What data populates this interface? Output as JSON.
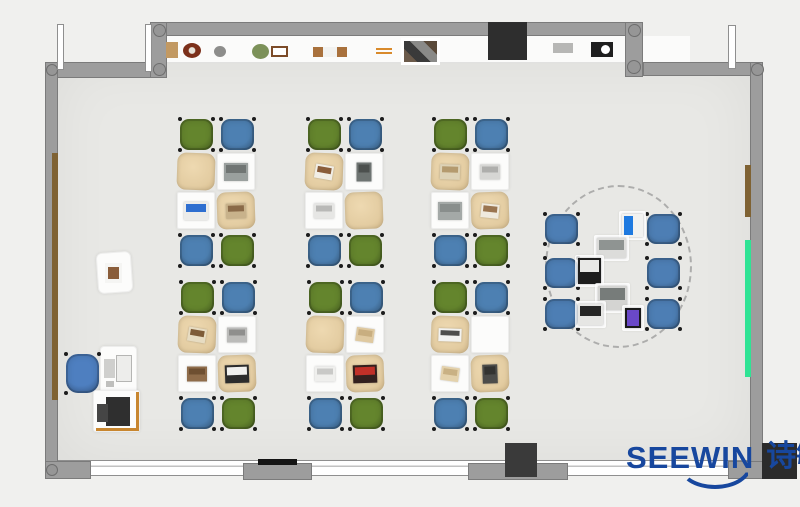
{
  "logo": {
    "text_latin": "SEEWIN",
    "text_cjk": "诗敏",
    "color": "#17479e",
    "x": 626,
    "y": 442
  },
  "palette": {
    "page_bg": "#f0f0ee",
    "floor": "#e8e8e5",
    "wall": "#9d9d9d",
    "alcove": "#fbfbfa",
    "chair_green": "#64852d",
    "chair_blue": "#4d80b2",
    "collab_chair_blue": "#4d7eb4",
    "office_chair_blue": "#4e7fc0",
    "desk_tan": "#e3cca1",
    "desk_white": "#fcfcfb",
    "door_brown": "#7f6233",
    "board_green": "#2fe394",
    "accent_orange": "#c8862f",
    "dark_block": "#2e2e2e"
  },
  "room": {
    "floor": {
      "x": 57,
      "y": 62,
      "w": 693,
      "h": 399
    },
    "alcove": {
      "x": 167,
      "y": 36,
      "w": 458,
      "h": 26
    },
    "alcove_right": {
      "x": 643,
      "y": 36,
      "w": 47,
      "h": 26
    },
    "walls": [
      {
        "name": "wall-top-left",
        "x": 45,
        "y": 62,
        "w": 113,
        "h": 16
      },
      {
        "name": "wall-top",
        "x": 150,
        "y": 22,
        "w": 493,
        "h": 14
      },
      {
        "name": "wall-jog-left",
        "x": 150,
        "y": 22,
        "w": 17,
        "h": 56
      },
      {
        "name": "wall-jog-right",
        "x": 625,
        "y": 22,
        "w": 18,
        "h": 55
      },
      {
        "name": "wall-top-right",
        "x": 643,
        "y": 62,
        "w": 120,
        "h": 14
      },
      {
        "name": "wall-left",
        "x": 45,
        "y": 62,
        "w": 13,
        "h": 416
      },
      {
        "name": "wall-right",
        "x": 750,
        "y": 62,
        "w": 13,
        "h": 416
      },
      {
        "name": "pier-bottom-1",
        "x": 45,
        "y": 461,
        "w": 46,
        "h": 18
      },
      {
        "name": "pier-bottom-2",
        "x": 243,
        "y": 463,
        "w": 69,
        "h": 17
      },
      {
        "name": "pier-bottom-3",
        "x": 468,
        "y": 463,
        "w": 100,
        "h": 17
      },
      {
        "name": "pier-bottom-4",
        "x": 728,
        "y": 461,
        "w": 35,
        "h": 18
      }
    ],
    "windows": [
      {
        "name": "window-bottom",
        "x": 50,
        "y": 460,
        "w": 702,
        "h": 16
      },
      {
        "name": "window-top-left",
        "x": 64,
        "y": 64,
        "w": 81,
        "h": 11
      },
      {
        "name": "window-top-right",
        "x": 649,
        "y": 64,
        "w": 78,
        "h": 11
      },
      {
        "name": "window-top-band",
        "x": 248,
        "y": 24,
        "w": 241,
        "h": 10
      }
    ],
    "door_leaves": [
      {
        "name": "door-leaf-1",
        "x": 57,
        "y": 24,
        "w": 7,
        "h": 46
      },
      {
        "name": "door-leaf-2",
        "x": 145,
        "y": 24,
        "w": 7,
        "h": 48
      },
      {
        "name": "door-leaf-3",
        "x": 728,
        "y": 25,
        "w": 8,
        "h": 44
      }
    ],
    "columns": [
      {
        "name": "column",
        "x": 46,
        "y": 64,
        "d": 12
      },
      {
        "name": "column",
        "x": 153,
        "y": 24,
        "d": 13
      },
      {
        "name": "column",
        "x": 153,
        "y": 63,
        "d": 13
      },
      {
        "name": "column",
        "x": 628,
        "y": 24,
        "d": 13
      },
      {
        "name": "column",
        "x": 627,
        "y": 60,
        "d": 14
      },
      {
        "name": "column",
        "x": 751,
        "y": 63,
        "d": 13
      },
      {
        "name": "column",
        "x": 46,
        "y": 464,
        "d": 12
      }
    ],
    "dark_blocks": [
      {
        "name": "wall-display",
        "x": 488,
        "y": 22,
        "w": 39,
        "h": 38,
        "color": "#2e2e2e"
      },
      {
        "name": "block-bottom-mid",
        "x": 505,
        "y": 443,
        "w": 32,
        "h": 34,
        "color": "#3a3a3a"
      },
      {
        "name": "block-bottom-right",
        "x": 762,
        "y": 443,
        "w": 35,
        "h": 36,
        "color": "#2b2b2b"
      },
      {
        "name": "threshold-bar",
        "x": 258,
        "y": 459,
        "w": 39,
        "h": 6,
        "color": "#141414"
      }
    ],
    "strips": [
      {
        "name": "door-panel-brown-left",
        "x": 52,
        "y": 153,
        "w": 6,
        "h": 247,
        "color": "#7f6233"
      },
      {
        "name": "panel-brown-right",
        "x": 745,
        "y": 165,
        "w": 6,
        "h": 52,
        "color": "#7f6233"
      },
      {
        "name": "board-green-right",
        "x": 745,
        "y": 240,
        "w": 6,
        "h": 137,
        "color": "#2fe394"
      }
    ]
  },
  "shelf_items": [
    {
      "name": "decor-wood-block",
      "x": 166,
      "y": 42,
      "w": 12,
      "h": 16,
      "shape": "rect",
      "color": "#c29962"
    },
    {
      "name": "decor-wreath",
      "x": 183,
      "y": 43,
      "w": 18,
      "h": 15,
      "shape": "ring",
      "color": "#7c301a"
    },
    {
      "name": "decor-stone",
      "x": 214,
      "y": 46,
      "w": 12,
      "h": 11,
      "shape": "circle",
      "color": "#8d8d8b"
    },
    {
      "name": "decor-plant",
      "x": 252,
      "y": 44,
      "w": 17,
      "h": 15,
      "shape": "circle",
      "color": "#7c9159"
    },
    {
      "name": "decor-frame",
      "x": 271,
      "y": 46,
      "w": 17,
      "h": 11,
      "shape": "frame",
      "color": "#7c4b28"
    },
    {
      "name": "decor-bench",
      "x": 313,
      "y": 47,
      "w": 34,
      "h": 10,
      "shape": "bench",
      "color": "#a9713c"
    },
    {
      "name": "decor-sticks",
      "x": 376,
      "y": 48,
      "w": 16,
      "h": 6,
      "shape": "lines",
      "color": "#d98a2b"
    },
    {
      "name": "decor-collage",
      "x": 404,
      "y": 41,
      "w": 33,
      "h": 21,
      "shape": "collage",
      "color": "#4a4440"
    },
    {
      "name": "decor-tray",
      "x": 553,
      "y": 43,
      "w": 20,
      "h": 10,
      "shape": "rect",
      "color": "#b7b7b5"
    },
    {
      "name": "decor-clock",
      "x": 591,
      "y": 42,
      "w": 22,
      "h": 15,
      "shape": "clock",
      "color": "#1f1f1f"
    }
  ],
  "clusters": {
    "desk_w": 40,
    "desk_h": 39,
    "chair_w": 37,
    "chair_h": 35,
    "chair_colors": [
      "green",
      "blue",
      "blue",
      "green"
    ],
    "units": [
      {
        "name": "desk-cluster-1",
        "x": 177,
        "y": 153,
        "desks": [
          {
            "surface": "tan",
            "item": null
          },
          {
            "surface": "white",
            "item": {
              "type": "laptop",
              "body": "#9aa09e",
              "screen": "#707573"
            }
          },
          {
            "surface": "white",
            "item": {
              "type": "laptop",
              "body": "#ececea",
              "screen": "#2f6fd0"
            }
          },
          {
            "surface": "tan",
            "item": {
              "type": "book",
              "body": "#c8b28b",
              "screen": "#8a6a48"
            }
          }
        ]
      },
      {
        "name": "desk-cluster-2",
        "x": 305,
        "y": 153,
        "desks": [
          {
            "surface": "tan",
            "item": {
              "type": "paper",
              "body": "#f1eee6",
              "screen": "#8a5d3a"
            }
          },
          {
            "surface": "white",
            "item": {
              "type": "tablet",
              "body": "#6e7472",
              "screen": "#4c504e"
            }
          },
          {
            "surface": "white",
            "item": {
              "type": "book",
              "body": "#e6e6e4",
              "screen": "#b9b9b7"
            }
          },
          {
            "surface": "tan",
            "item": null
          }
        ]
      },
      {
        "name": "desk-cluster-3",
        "x": 431,
        "y": 153,
        "desks": [
          {
            "surface": "tan",
            "item": {
              "type": "book",
              "body": "#ddd2b6",
              "screen": "#b49a6e"
            }
          },
          {
            "surface": "white",
            "item": {
              "type": "book",
              "body": "#d6d6d4",
              "screen": "#aeaeac"
            }
          },
          {
            "surface": "white",
            "item": {
              "type": "laptop",
              "body": "#a4a9a7",
              "screen": "#898e8c"
            }
          },
          {
            "surface": "tan",
            "item": {
              "type": "paper",
              "body": "#efeade",
              "screen": "#9a7550"
            }
          }
        ]
      },
      {
        "name": "desk-cluster-4",
        "x": 178,
        "y": 316,
        "desks": [
          {
            "surface": "tan",
            "item": {
              "type": "paper",
              "body": "#e7dcc2",
              "screen": "#7e5c38"
            }
          },
          {
            "surface": "white",
            "item": {
              "type": "book",
              "body": "#bbbbb9",
              "screen": "#8f8f8d"
            }
          },
          {
            "surface": "white",
            "item": {
              "type": "book",
              "body": "#8f6c4a",
              "screen": "#6e4f31"
            }
          },
          {
            "surface": "tan",
            "item": {
              "type": "laptop",
              "body": "#2c2c2c",
              "screen": "#f0f0ee"
            }
          }
        ]
      },
      {
        "name": "desk-cluster-5",
        "x": 306,
        "y": 316,
        "desks": [
          {
            "surface": "tan",
            "item": null
          },
          {
            "surface": "white",
            "item": {
              "type": "paper",
              "body": "#dfc9a0",
              "screen": "#c8ae80"
            }
          },
          {
            "surface": "white",
            "item": {
              "type": "book",
              "body": "#efefed",
              "screen": "#c9c9c7"
            }
          },
          {
            "surface": "tan",
            "item": {
              "type": "laptop",
              "body": "#33201e",
              "screen": "#c03028"
            }
          }
        ]
      },
      {
        "name": "desk-cluster-6",
        "x": 431,
        "y": 316,
        "desks": [
          {
            "surface": "tan",
            "item": {
              "type": "keyboard",
              "body": "#f2f2f0",
              "screen": "#4e4e4c"
            }
          },
          {
            "surface": "white",
            "item": null
          },
          {
            "surface": "white",
            "item": {
              "type": "paper",
              "body": "#e4d2ac",
              "screen": "#c9b184"
            }
          },
          {
            "surface": "tan",
            "item": {
              "type": "tablet",
              "body": "#4c4c4a",
              "screen": "#333331"
            }
          }
        ]
      }
    ]
  },
  "collab": {
    "ellipse": {
      "x": 545,
      "y": 185,
      "w": 147,
      "h": 163
    },
    "chair_w": 37,
    "chair_h": 34,
    "chairs": [
      {
        "x": 543,
        "y": 212
      },
      {
        "x": 543,
        "y": 256
      },
      {
        "x": 543,
        "y": 297
      },
      {
        "x": 645,
        "y": 212
      },
      {
        "x": 645,
        "y": 256
      },
      {
        "x": 645,
        "y": 297
      }
    ],
    "devices": [
      {
        "name": "tablet-blue",
        "x": 622,
        "y": 214,
        "w": 21,
        "h": 23,
        "body": "#f2f2f0",
        "screen": "#1f7ae0",
        "orient": "left"
      },
      {
        "name": "laptop-gray-1",
        "x": 597,
        "y": 238,
        "w": 29,
        "h": 20,
        "body": "#dcdcda",
        "screen": "#8f9492",
        "orient": "top"
      },
      {
        "name": "laptop-black",
        "x": 578,
        "y": 258,
        "w": 23,
        "h": 26,
        "body": "#1d1d1d",
        "screen": "#e8e8e6",
        "orient": "top"
      },
      {
        "name": "laptop-gray-2",
        "x": 598,
        "y": 286,
        "w": 29,
        "h": 24,
        "body": "#d4d4d2",
        "screen": "#777c7a",
        "orient": "top"
      },
      {
        "name": "laptop-white",
        "x": 578,
        "y": 304,
        "w": 25,
        "h": 21,
        "body": "#e6e6e4",
        "screen": "#262626",
        "orient": "top"
      },
      {
        "name": "smartphone",
        "x": 625,
        "y": 308,
        "w": 16,
        "h": 20,
        "body": "#1a1a1a",
        "screen": "#6a48c8",
        "orient": "full"
      }
    ]
  },
  "teacher": {
    "side_table": {
      "x": 97,
      "y": 252,
      "w": 35,
      "h": 41,
      "rot": -4
    },
    "side_item": {
      "x": 105,
      "y": 263,
      "w": 17,
      "h": 20,
      "body": "#f5f5f3",
      "center": "#8a5d3a"
    },
    "chair": {
      "x": 64,
      "y": 352,
      "w": 37,
      "h": 43,
      "color": "#4e7fc0"
    },
    "desk": {
      "x": 100,
      "y": 346,
      "w": 37,
      "h": 50
    },
    "monitor1": {
      "x": 104,
      "y": 359,
      "w": 11,
      "h": 19,
      "color": "#cfcfcd"
    },
    "monitor2": {
      "x": 117,
      "y": 356,
      "w": 14,
      "h": 25,
      "color": "#ededeb"
    },
    "small_item": {
      "x": 106,
      "y": 381,
      "w": 8,
      "h": 6,
      "color": "#bfbfbd"
    },
    "printer_stand": {
      "x": 93,
      "y": 390,
      "w": 47,
      "h": 42
    },
    "printer_body": {
      "x": 106,
      "y": 397,
      "w": 24,
      "h": 29,
      "color": "#2f2f2f"
    },
    "printer_side": {
      "x": 97,
      "y": 404,
      "w": 11,
      "h": 18,
      "color": "#454545"
    },
    "orange_v": {
      "x": 136,
      "y": 392,
      "w": 3,
      "h": 39,
      "color": "#c8862f"
    },
    "orange_h": {
      "x": 96,
      "y": 428,
      "w": 43,
      "h": 3,
      "color": "#c8862f"
    }
  }
}
